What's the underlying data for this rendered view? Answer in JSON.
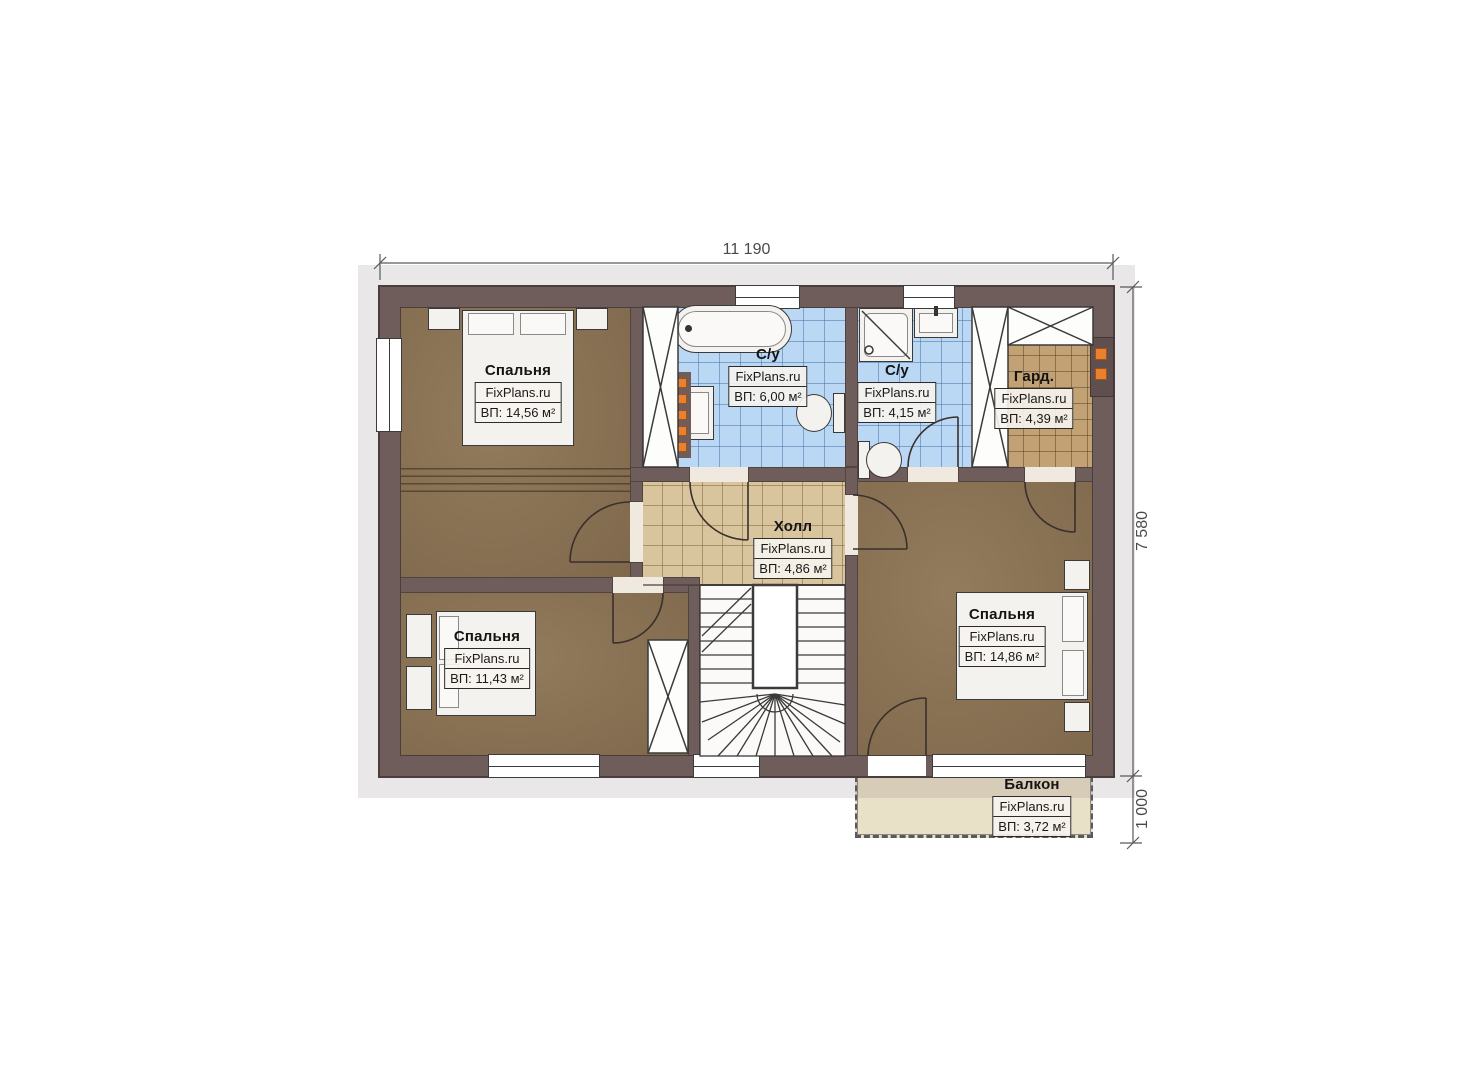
{
  "watermark": "FixPlans.ru",
  "dimensions": {
    "top_width": "11 190",
    "right_height": "7 580",
    "balcony_depth": "1 000"
  },
  "rooms": {
    "bedroom_top_left": {
      "name": "Спальня",
      "area": "ВП: 14,56 м²"
    },
    "bathroom_main": {
      "name": "С/у",
      "area": "ВП: 6,00 м²"
    },
    "bathroom_ensuite": {
      "name": "С/у",
      "area": "ВП: 4,15 м²"
    },
    "wardrobe": {
      "name": "Гард.",
      "area": "ВП: 4,39 м²"
    },
    "hall": {
      "name": "Холл",
      "area": "ВП: 4,86 м²"
    },
    "bedroom_bottom_left": {
      "name": "Спальня",
      "area": "ВП: 11,43 м²"
    },
    "bedroom_master": {
      "name": "Спальня",
      "area": "ВП: 14,86 м²"
    },
    "balcony": {
      "name": "Балкон",
      "area": "ВП: 3,72 м²"
    }
  }
}
